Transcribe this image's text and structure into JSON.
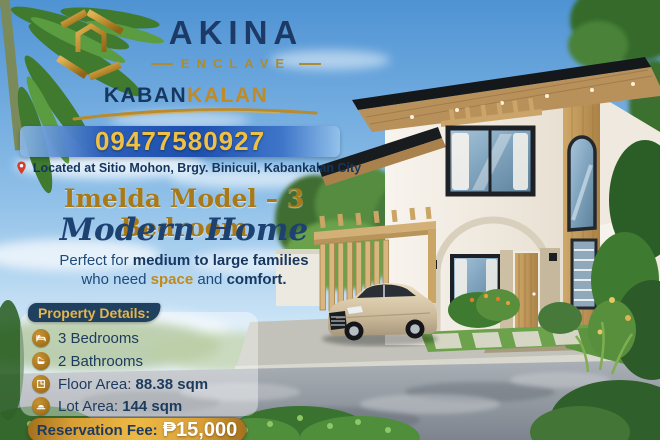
{
  "brand": {
    "name": "AKINA",
    "tagline": "ENCLAVE",
    "city_part1": "KABAN",
    "city_part2": "KALAN"
  },
  "contact": {
    "phone": "09477580927",
    "address": "Located at Sitio Mohon, Brgy. Binicuil, Kabankalan City"
  },
  "headline": {
    "title": "Imelda Model – 3 Bedroom",
    "subtitle_script": "Modern Home",
    "description": {
      "part1": "Perfect for ",
      "part2_bold": "medium to large families",
      "part3": "who need ",
      "part4_gold": "space",
      "part5": " and ",
      "part6_bold": "comfort."
    }
  },
  "property_details": {
    "header": "Property Details:",
    "items": [
      {
        "icon": "bed-icon",
        "text": "3 Bedrooms"
      },
      {
        "icon": "bathtub-icon",
        "text": "2 Bathrooms"
      },
      {
        "icon": "floor-plan-icon",
        "label": "Floor Area: ",
        "value": "88.38 sqm"
      },
      {
        "icon": "lot-area-icon",
        "label": "Lot Area: ",
        "value": "144 sqm"
      }
    ]
  },
  "reservation": {
    "label": "Reservation Fee:",
    "value": "₱15,000"
  },
  "colors": {
    "navy": "#16375f",
    "gold_heading": "#a87916",
    "logo_gold": "#c09a3e",
    "band_blue": "#1d4fae",
    "phone_gold": "#eec043",
    "pill_gold": "#d79e35",
    "banner_navy": "#20405f"
  }
}
